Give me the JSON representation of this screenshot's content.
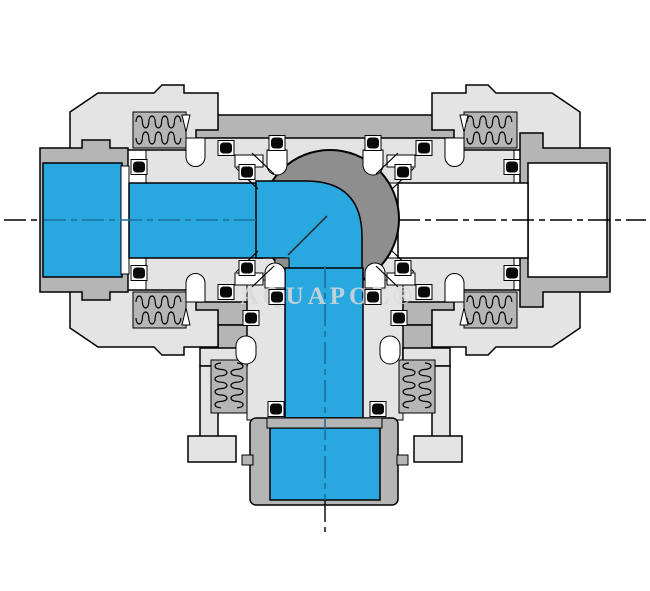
{
  "diagram": {
    "watermark": "AQUAPOL®",
    "colors": {
      "background": "#ffffff",
      "flow_path": "#29a8df",
      "body_light": "#e4e4e4",
      "body_mid": "#b5b5b5",
      "ball": "#8e8e8e",
      "outline": "#000000",
      "centerline_flow": "#1b6f9e",
      "oring": "#0a0a0a",
      "watermark_color": "#d9d9d9"
    },
    "components": {
      "type": "3-way L-port ball valve cross-section",
      "left_port": "inlet (open, blue flow)",
      "bottom_port": "outlet (open, blue flow)",
      "right_port": "closed port (white)",
      "union_nut_count": 4,
      "o_ring_count": 20
    }
  }
}
